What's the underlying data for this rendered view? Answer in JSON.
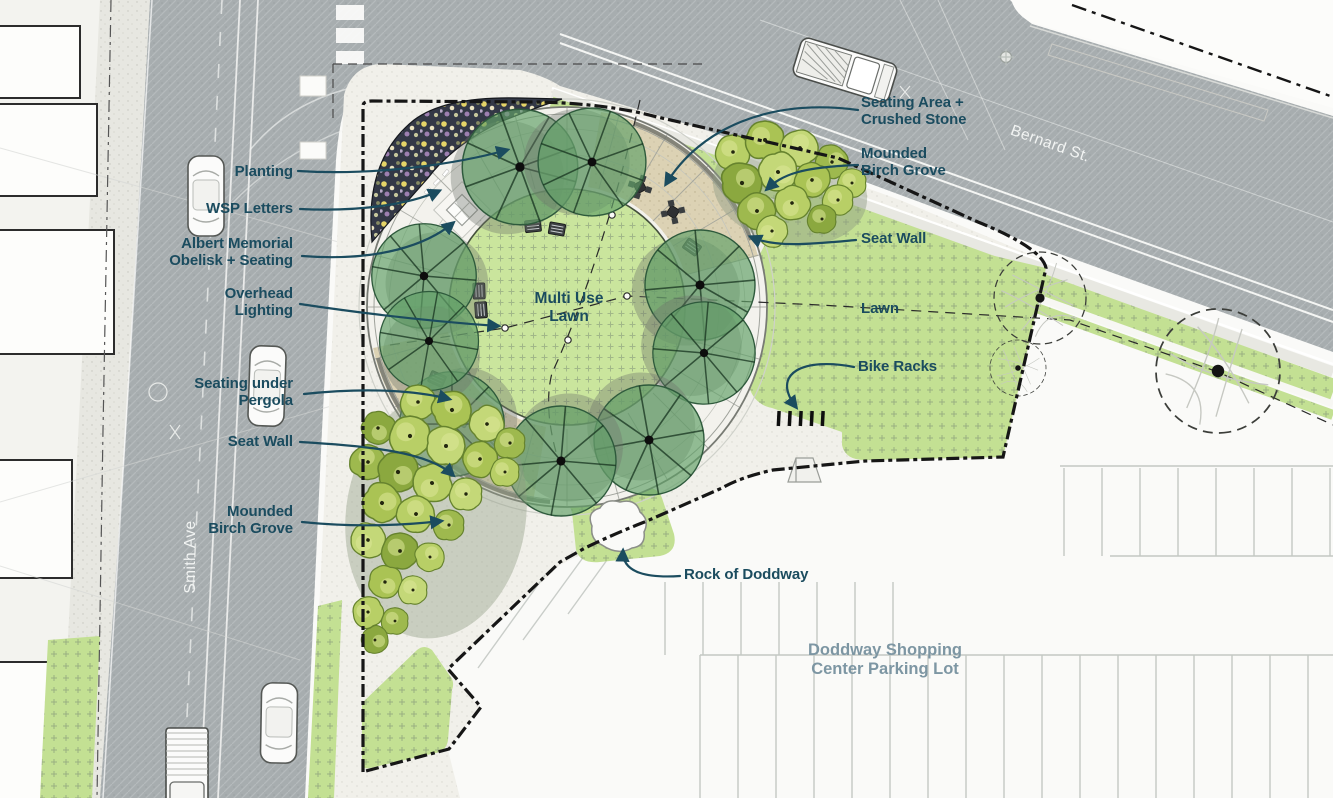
{
  "drawing_type": "landscape site plan",
  "colors": {
    "callout_teal": "#1B4C5F",
    "road_gray": "#A7ADAF",
    "lawn_green": "#C3E093",
    "shade_tree_green": "#63A169",
    "birch_green": "#B6CD62",
    "boundary_black": "#161616",
    "parking_label_gray": "#7D96A3",
    "crushed_stone_tan": "#DCD2B4",
    "planting_bed_dark": "#333846"
  },
  "callouts_left": [
    {
      "id": "planting",
      "label": "Planting"
    },
    {
      "id": "wsp-letters",
      "label": "WSP Letters"
    },
    {
      "id": "albert-memorial",
      "label": "Albert Memorial\nObelisk + Seating"
    },
    {
      "id": "overhead-lighting",
      "label": "Overhead\nLighting"
    },
    {
      "id": "seating-under-pergola",
      "label": "Seating under\nPergola"
    },
    {
      "id": "seat-wall-west",
      "label": "Seat Wall"
    },
    {
      "id": "mounded-birch-grove-south",
      "label": "Mounded\nBirch Grove"
    }
  ],
  "callouts_right": [
    {
      "id": "seating-area-crushed-stone",
      "label": "Seating Area +\nCrushed Stone"
    },
    {
      "id": "mounded-birch-grove-north",
      "label": "Mounded\nBirch Grove"
    },
    {
      "id": "seat-wall-east",
      "label": "Seat Wall"
    },
    {
      "id": "lawn",
      "label": "Lawn"
    },
    {
      "id": "bike-racks",
      "label": "Bike Racks"
    },
    {
      "id": "rock-of-doddway",
      "label": "Rock of Doddway"
    }
  ],
  "area_labels": {
    "multi_use_lawn": "Multi Use\nLawn",
    "parking_lot": "Doddway Shopping\nCenter Parking Lot"
  },
  "street_labels": {
    "bernard_st": "Bernard St.",
    "smith_ave": "Smith Ave"
  }
}
